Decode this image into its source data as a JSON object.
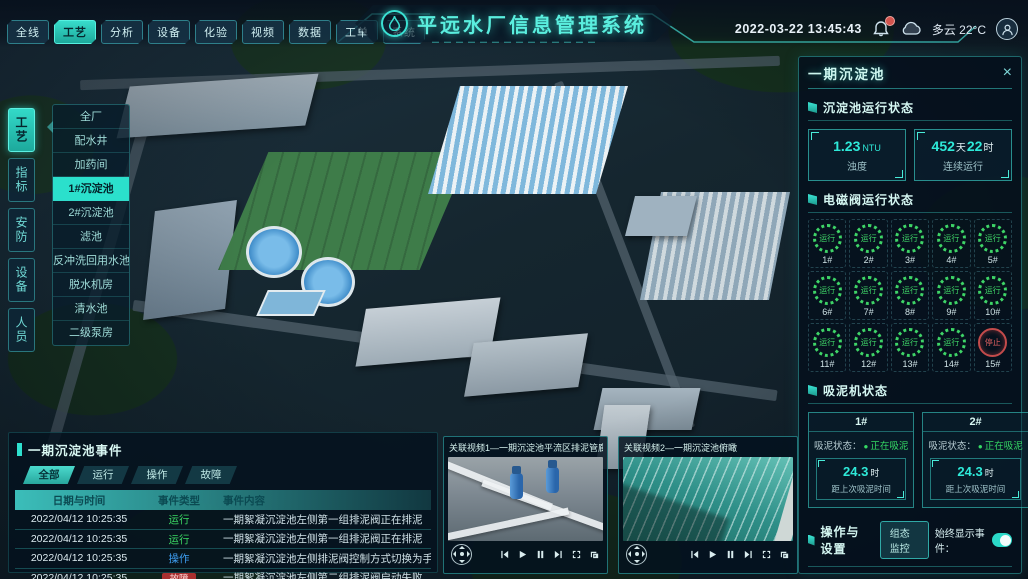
{
  "header": {
    "nav": [
      {
        "label": "全线"
      },
      {
        "label": "工艺"
      },
      {
        "label": "分析"
      },
      {
        "label": "设备"
      },
      {
        "label": "化验"
      },
      {
        "label": "视频"
      },
      {
        "label": "数据"
      },
      {
        "label": "工单"
      },
      {
        "label": "系统"
      }
    ],
    "title": "平远水厂信息管理系统",
    "datetime": "2022-03-22 13:45:43",
    "weather": "多云 22°C"
  },
  "side_tabs": [
    {
      "label": "工艺"
    },
    {
      "label": "指标"
    },
    {
      "label": "安防"
    },
    {
      "label": "设备"
    },
    {
      "label": "人员"
    }
  ],
  "process_menu": [
    "全厂",
    "配水井",
    "加药间",
    "1#沉淀池",
    "2#沉淀池",
    "滤池",
    "反冲洗回用水池",
    "脱水机房",
    "清水池",
    "二级泵房"
  ],
  "right_panel": {
    "title": "一期沉淀池",
    "close": "×",
    "pond_status": {
      "title": "沉淀池运行状态",
      "turbidity": {
        "value": "1.23",
        "unit": "NTU",
        "label": "浊度"
      },
      "uptime": {
        "v1": "452",
        "u1": "天",
        "v2": "22",
        "u2": "时",
        "label": "连续运行"
      }
    },
    "valves": {
      "title": "电磁阀运行状态",
      "items": [
        {
          "id": "1#",
          "status": "运行"
        },
        {
          "id": "2#",
          "status": "运行"
        },
        {
          "id": "3#",
          "status": "运行"
        },
        {
          "id": "4#",
          "status": "运行"
        },
        {
          "id": "5#",
          "status": "运行"
        },
        {
          "id": "6#",
          "status": "运行"
        },
        {
          "id": "7#",
          "status": "运行"
        },
        {
          "id": "8#",
          "status": "运行"
        },
        {
          "id": "9#",
          "status": "运行"
        },
        {
          "id": "10#",
          "status": "运行"
        },
        {
          "id": "11#",
          "status": "运行"
        },
        {
          "id": "12#",
          "status": "运行"
        },
        {
          "id": "13#",
          "status": "运行"
        },
        {
          "id": "14#",
          "status": "运行"
        },
        {
          "id": "15#",
          "status": "停止"
        }
      ]
    },
    "scrapers": {
      "title": "吸泥机状态",
      "status_label": "吸泥状态：",
      "dot": "●",
      "machines": [
        {
          "id": "1#",
          "status": "正在吸泥",
          "value": "24.3",
          "unit": "时",
          "label": "距上次吸泥时间"
        },
        {
          "id": "2#",
          "status": "正在吸泥",
          "value": "24.3",
          "unit": "时",
          "label": "距上次吸泥时间"
        }
      ]
    },
    "ops": {
      "title": "操作与设置",
      "button": "组态监控",
      "toggle_label": "始终显示事件："
    }
  },
  "events": {
    "title": "一期沉淀池事件",
    "tabs": [
      {
        "label": "全部"
      },
      {
        "label": "运行"
      },
      {
        "label": "操作"
      },
      {
        "label": "故障"
      }
    ],
    "columns": [
      "日期与时间",
      "事件类型",
      "事件内容"
    ],
    "rows": [
      {
        "time": "2022/04/12 10:25:35",
        "type": "运行",
        "content": "一期絮凝沉淀池左侧第一组排泥阀正在排泥"
      },
      {
        "time": "2022/04/12 10:25:35",
        "type": "运行",
        "content": "一期絮凝沉淀池左侧第一组排泥阀正在排泥"
      },
      {
        "time": "2022/04/12 10:25:35",
        "type": "操作",
        "content": "一期絮凝沉淀池左侧排泥阀控制方式切换为手动"
      },
      {
        "time": "2022/04/12 10:25:35",
        "type": "故障",
        "content": "一期絮凝沉淀池左侧第二组排泥阀启动失败"
      }
    ]
  },
  "videos": [
    {
      "title": "关联视频1—一期沉淀池平流区排泥管廊"
    },
    {
      "title": "关联视频2—一期沉淀池俯瞰"
    }
  ],
  "colors": {
    "accent": "#35e0d0",
    "green": "#3bd964",
    "red": "#e05252",
    "blue": "#3d9df0"
  }
}
